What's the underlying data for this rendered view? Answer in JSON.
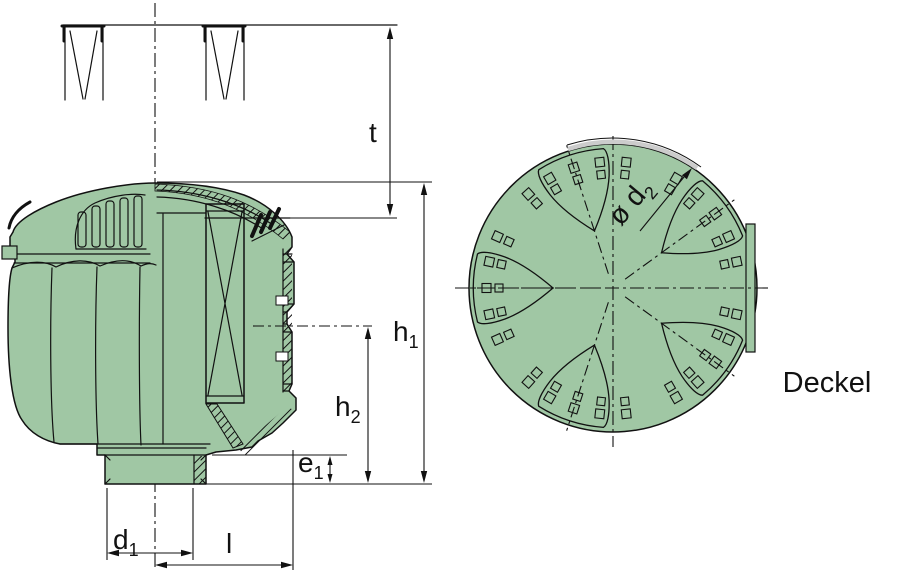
{
  "colors": {
    "part_fill": "#a0c7a4",
    "line": "#111111",
    "highlight_arc": "#cccccc",
    "background": "#ffffff"
  },
  "side_view": {
    "dimensions": {
      "t": {
        "main": "t",
        "sub": ""
      },
      "h1": {
        "main": "h",
        "sub": "1"
      },
      "h2": {
        "main": "h",
        "sub": "2"
      },
      "e1": {
        "main": "e",
        "sub": "1"
      },
      "d1": {
        "main": "d",
        "sub": "1"
      },
      "l": {
        "main": "l",
        "sub": ""
      }
    }
  },
  "top_view": {
    "label": "Deckel",
    "dimensions": {
      "d2": {
        "main": "ø d",
        "sub": "2"
      }
    }
  }
}
